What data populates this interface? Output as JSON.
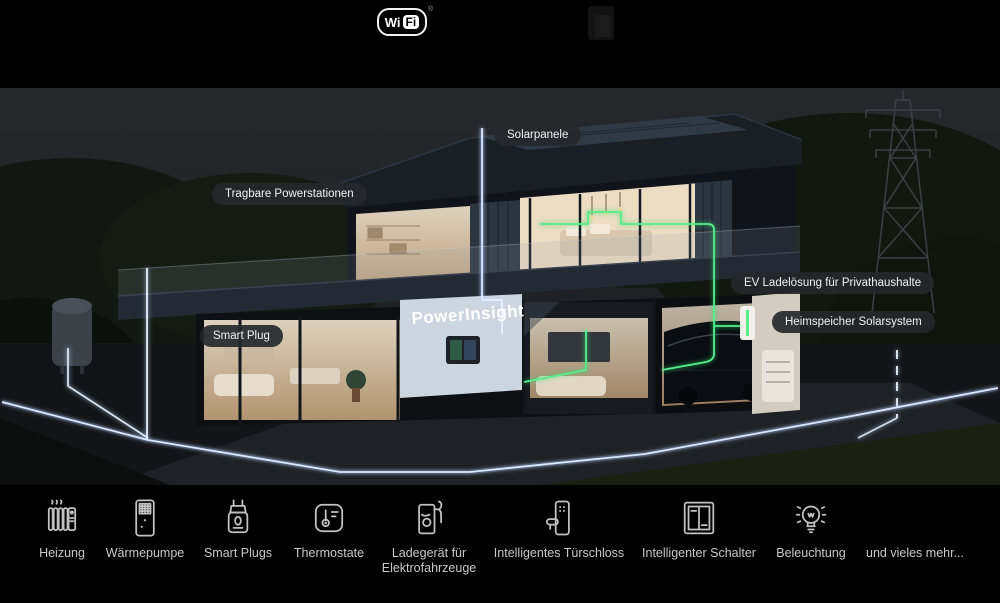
{
  "header": {
    "wifi_logo": {
      "part1": "Wi",
      "part2": "Fi",
      "registered": "®"
    }
  },
  "scene": {
    "brand": "PowerInsight",
    "callouts": [
      {
        "label": "Solarpanele"
      },
      {
        "label": "Tragbare Powerstationen"
      },
      {
        "label": "EV Ladelösung für Privathaushalte"
      },
      {
        "label": "Heimspeicher Solarsystem"
      },
      {
        "label": "Smart Plug"
      }
    ],
    "colors": {
      "accent_green": "#55ef8c",
      "line_white": "#e9f2ff",
      "callout_bg": "rgba(37,40,43,0.92)"
    }
  },
  "dock": {
    "items": [
      {
        "label": "Heizung",
        "icon": "radiator-icon"
      },
      {
        "label": "Wärmepumpe",
        "icon": "heat-pump-icon"
      },
      {
        "label": "Smart Plugs",
        "icon": "smart-plug-icon"
      },
      {
        "label": "Thermostate",
        "icon": "thermostat-icon"
      },
      {
        "label": "Ladegerät für Elektrofahrzeuge",
        "icon": "ev-charger-icon"
      },
      {
        "label": "Intelligentes Türschloss",
        "icon": "smart-lock-icon"
      },
      {
        "label": "Intelligenter Schalter",
        "icon": "smart-switch-icon"
      },
      {
        "label": "Beleuchtung",
        "icon": "light-bulb-icon"
      },
      {
        "label": "und vieles mehr...",
        "icon": null
      }
    ]
  }
}
